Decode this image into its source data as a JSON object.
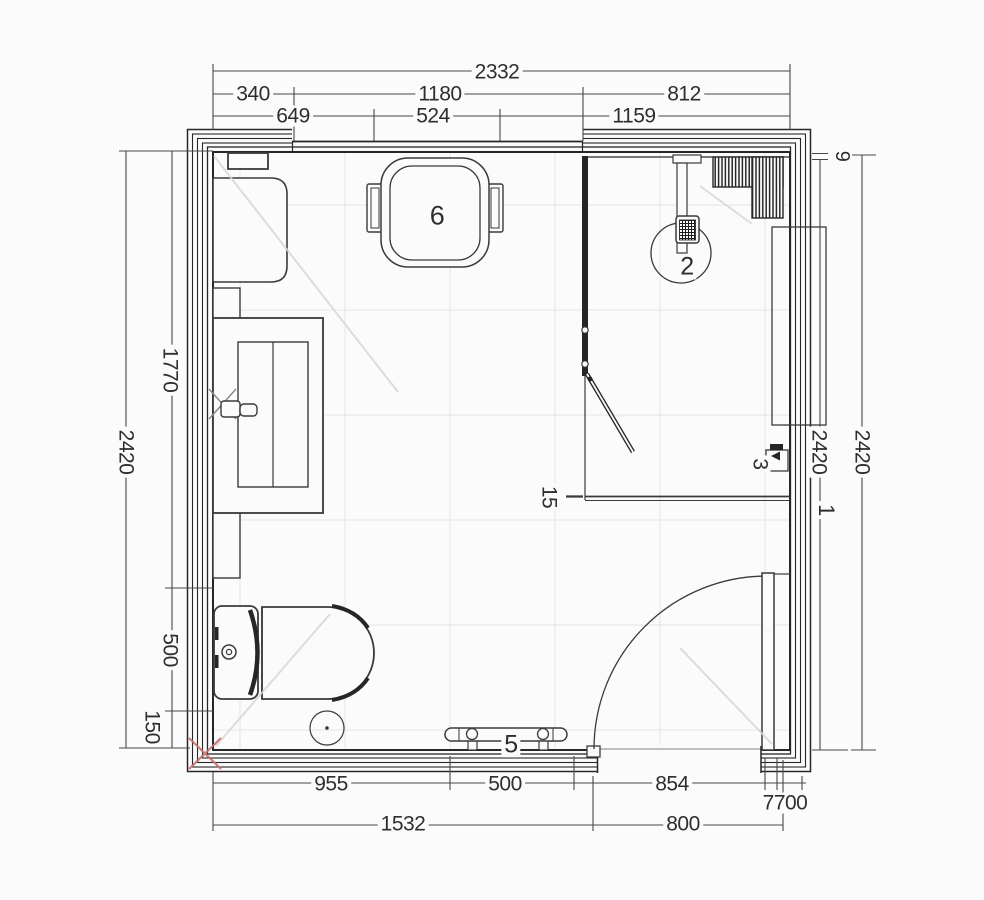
{
  "drawing": {
    "title": "bathroom-floor-plan",
    "background": "#fbfbfb",
    "line_color": "#3a3a3a",
    "wall_color": "#262626",
    "grid_color": "#e4e4e4",
    "accent_red": "#c4716e",
    "icons": {
      "toilet": "toilet-plan-symbol",
      "shower_drain": "shower-drain-symbol",
      "door": "door-swing-symbol",
      "towel_rail": "towel-rail-symbol",
      "radiator": "hatched-radiator-symbol",
      "stool": "stool-symbol",
      "washbasin": "vanity-basin-symbol",
      "floor_drain": "floor-drain-symbol",
      "faucet": "faucet-cross-symbol"
    }
  },
  "labels": [
    {
      "name": "dim-top-total-2332",
      "text": "2332",
      "x": 497,
      "y": 72,
      "rot": 0,
      "size": 21
    },
    {
      "name": "dim-top-340",
      "text": "340",
      "x": 253,
      "y": 94,
      "rot": 0,
      "size": 21
    },
    {
      "name": "dim-top-1180",
      "text": "1180",
      "x": 440,
      "y": 94,
      "rot": 0,
      "size": 21
    },
    {
      "name": "dim-top-812",
      "text": "812",
      "x": 684,
      "y": 94,
      "rot": 0,
      "size": 21
    },
    {
      "name": "dim-top-649",
      "text": "649",
      "x": 293,
      "y": 116,
      "rot": 0,
      "size": 21
    },
    {
      "name": "dim-top-524",
      "text": "524",
      "x": 433,
      "y": 116,
      "rot": 0,
      "size": 21
    },
    {
      "name": "dim-top-1159",
      "text": "1159",
      "x": 634,
      "y": 116,
      "rot": 0,
      "size": 21
    },
    {
      "name": "dim-left-2420",
      "text": "2420",
      "x": 126,
      "y": 452,
      "rot": 90,
      "size": 21
    },
    {
      "name": "dim-left-1770",
      "text": "1770",
      "x": 170,
      "y": 370,
      "rot": 90,
      "size": 21
    },
    {
      "name": "dim-left-500",
      "text": "500",
      "x": 170,
      "y": 650,
      "rot": 90,
      "size": 21
    },
    {
      "name": "dim-left-150",
      "text": "150",
      "x": 152,
      "y": 727,
      "rot": 90,
      "size": 21
    },
    {
      "name": "dim-right-9",
      "text": "9",
      "x": 842,
      "y": 156,
      "rot": 90,
      "size": 20
    },
    {
      "name": "dim-right-2420-inner",
      "text": "2420",
      "x": 819,
      "y": 452,
      "rot": 90,
      "size": 21
    },
    {
      "name": "dim-right-2420-outer",
      "text": "2420",
      "x": 862,
      "y": 452,
      "rot": 90,
      "size": 21
    },
    {
      "name": "item-label-1",
      "text": "1",
      "x": 826,
      "y": 510,
      "rot": 90,
      "size": 22
    },
    {
      "name": "item-label-3",
      "text": "3",
      "x": 760,
      "y": 464,
      "rot": 90,
      "size": 21
    },
    {
      "name": "item-label-15",
      "text": "15",
      "x": 549,
      "y": 497,
      "rot": 90,
      "size": 21
    },
    {
      "name": "item-label-2",
      "text": "2",
      "x": 687,
      "y": 267,
      "rot": 0,
      "size": 25
    },
    {
      "name": "item-label-6",
      "text": "6",
      "x": 437,
      "y": 216,
      "rot": 0,
      "size": 27
    },
    {
      "name": "item-label-5",
      "text": "5",
      "x": 511,
      "y": 745,
      "rot": 0,
      "size": 25
    },
    {
      "name": "dim-bottom-955",
      "text": "955",
      "x": 331,
      "y": 784,
      "rot": 0,
      "size": 21
    },
    {
      "name": "dim-bottom-500",
      "text": "500",
      "x": 505,
      "y": 784,
      "rot": 0,
      "size": 21
    },
    {
      "name": "dim-bottom-854",
      "text": "854",
      "x": 672,
      "y": 784,
      "rot": 0,
      "size": 21
    },
    {
      "name": "dim-bottom-7700",
      "text": "7700",
      "x": 785,
      "y": 803,
      "rot": 0,
      "size": 21
    },
    {
      "name": "dim-bottom-1532",
      "text": "1532",
      "x": 403,
      "y": 824,
      "rot": 0,
      "size": 21
    },
    {
      "name": "dim-bottom-800",
      "text": "800",
      "x": 683,
      "y": 824,
      "rot": 0,
      "size": 21
    }
  ]
}
